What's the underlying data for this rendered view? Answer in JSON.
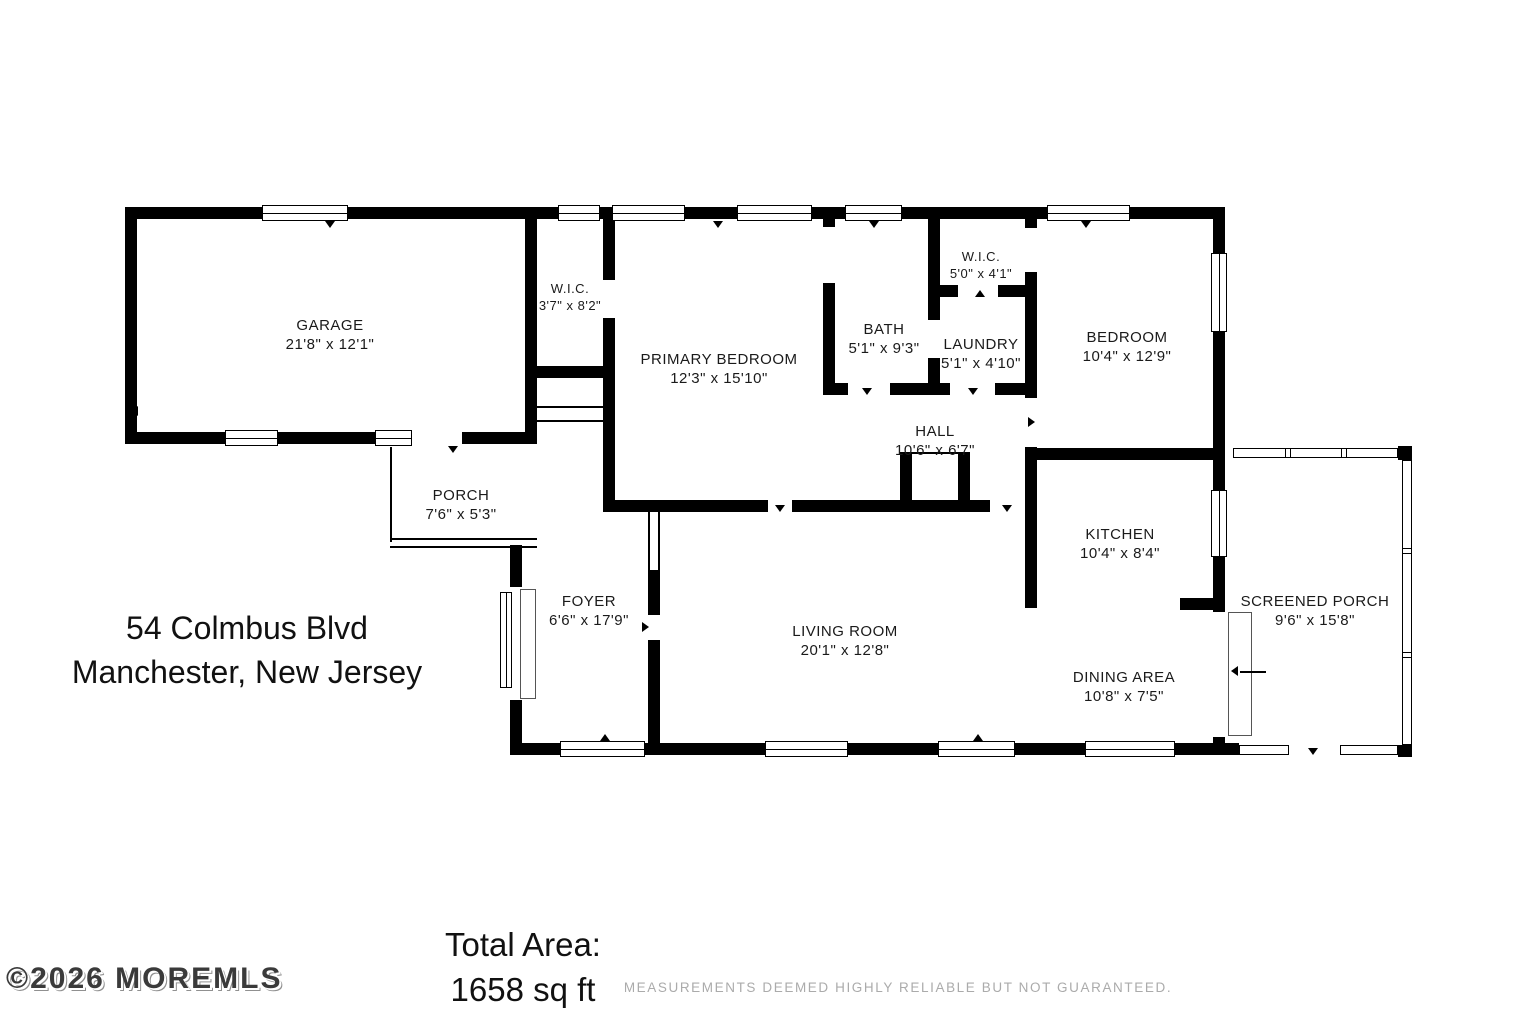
{
  "address": {
    "line1": "54 Colmbus Blvd",
    "line2": "Manchester, New Jersey"
  },
  "total_area": {
    "label": "Total Area:",
    "value": "1658 sq ft"
  },
  "watermark": "©2026 MOREMLS",
  "disclaimer": "MEASUREMENTS DEEMED HIGHLY RELIABLE BUT NOT GUARANTEED.",
  "rooms": {
    "garage": {
      "name": "GARAGE",
      "dims": "21'8\" x 12'1\""
    },
    "wic_left": {
      "name": "W.I.C.",
      "dims": "3'7\" x 8'2\""
    },
    "primary_bedroom": {
      "name": "PRIMARY BEDROOM",
      "dims": "12'3\" x 15'10\""
    },
    "bath": {
      "name": "BATH",
      "dims": "5'1\" x 9'3\""
    },
    "wic_right": {
      "name": "W.I.C.",
      "dims": "5'0\" x 4'1\""
    },
    "laundry": {
      "name": "LAUNDRY",
      "dims": "5'1\" x 4'10\""
    },
    "bedroom": {
      "name": "BEDROOM",
      "dims": "10'4\" x 12'9\""
    },
    "hall": {
      "name": "HALL",
      "dims": "10'6\" x 6'7\""
    },
    "porch": {
      "name": "PORCH",
      "dims": "7'6\" x 5'3\""
    },
    "kitchen": {
      "name": "KITCHEN",
      "dims": "10'4\" x 8'4\""
    },
    "screened_porch": {
      "name": "SCREENED PORCH",
      "dims": "9'6\" x 15'8\""
    },
    "foyer": {
      "name": "FOYER",
      "dims": "6'6\" x 17'9\""
    },
    "living_room": {
      "name": "LIVING ROOM",
      "dims": "20'1\" x 12'8\""
    },
    "dining_area": {
      "name": "DINING AREA",
      "dims": "10'8\" x 7'5\""
    }
  }
}
